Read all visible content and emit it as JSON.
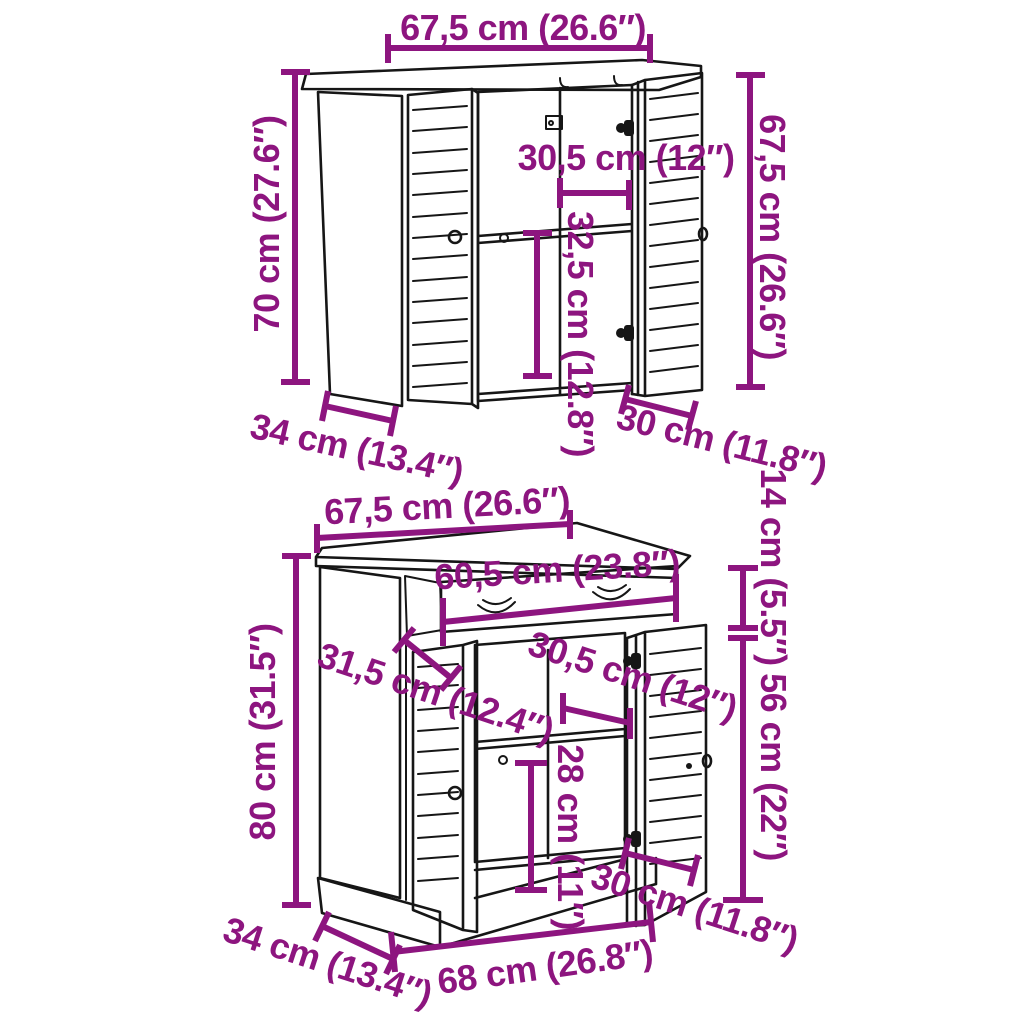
{
  "colors": {
    "dimension": "#8d157f",
    "ink": "#161616",
    "background": "#ffffff"
  },
  "top_cabinet": {
    "dimensions": {
      "width_top": "67,5 cm (26.6″)",
      "height_left": "70 cm (27.6″)",
      "inner_width": "30,5 cm (12″)",
      "inner_height": "32,5 cm (12.8″)",
      "height_right": "67,5 cm (26.6″)",
      "depth": "34 cm (13.4″)",
      "door_width": "30 cm (11.8″)"
    }
  },
  "bottom_cabinet": {
    "dimensions": {
      "width_top": "67,5 cm (26.6″)",
      "drawer_width": "60,5 cm (23.8″)",
      "drawer_height": "14 cm (5.5″)",
      "inner_depth": "31,5 cm (12.4″)",
      "inner_width": "30,5 cm (12″)",
      "door_height": "56 cm (22″)",
      "inner_height": "28 cm (11″)",
      "height_left": "80 cm (31.5″)",
      "depth": "34 cm (13.4″)",
      "width_bottom": "68 cm (26.8″)",
      "door_width": "30 cm (11.8″)"
    }
  }
}
